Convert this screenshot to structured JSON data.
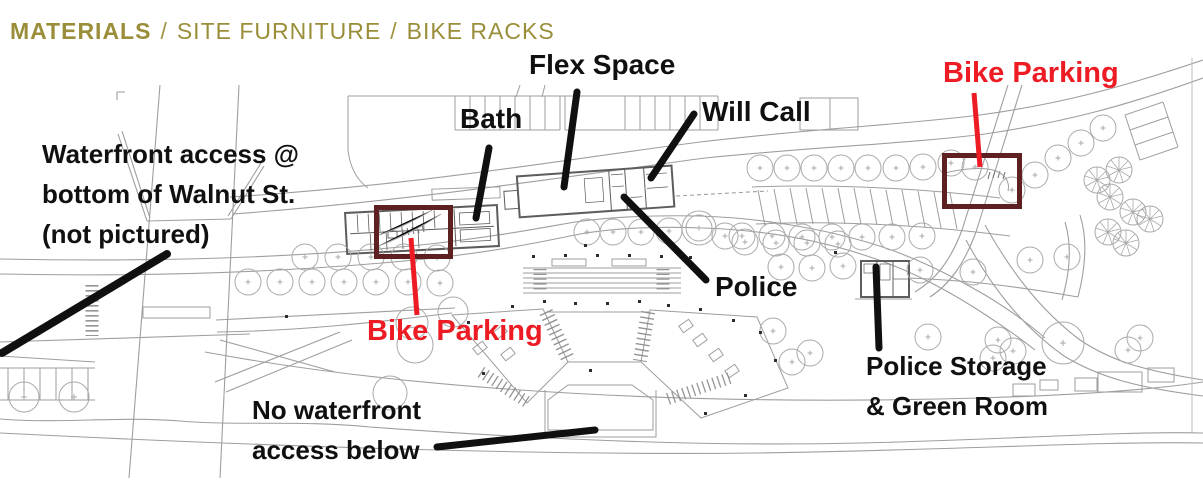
{
  "header": {
    "title_primary": "MATERIALS",
    "separator": "/",
    "title_secondary": "SITE FURNITURE",
    "title_tertiary": "BIKE RACKS"
  },
  "annotations": {
    "flex_space": "Flex Space",
    "bath": "Bath",
    "will_call": "Will Call",
    "police": "Police",
    "police_storage": "Police Storage\n& Green Room",
    "waterfront_access": "Waterfront access @\nbottom of Walnut St.\n(not pictured)",
    "no_waterfront": "No waterfront\naccess below",
    "bike_parking_left": "Bike Parking",
    "bike_parking_right": "Bike Parking"
  },
  "colors": {
    "title_olive": "#9a8e3a",
    "annotation_black": "#101010",
    "bike_red": "#ed1c24",
    "highlight_box_maroon": "#5e2020",
    "plan_line_gray": "#9e9e9e"
  }
}
